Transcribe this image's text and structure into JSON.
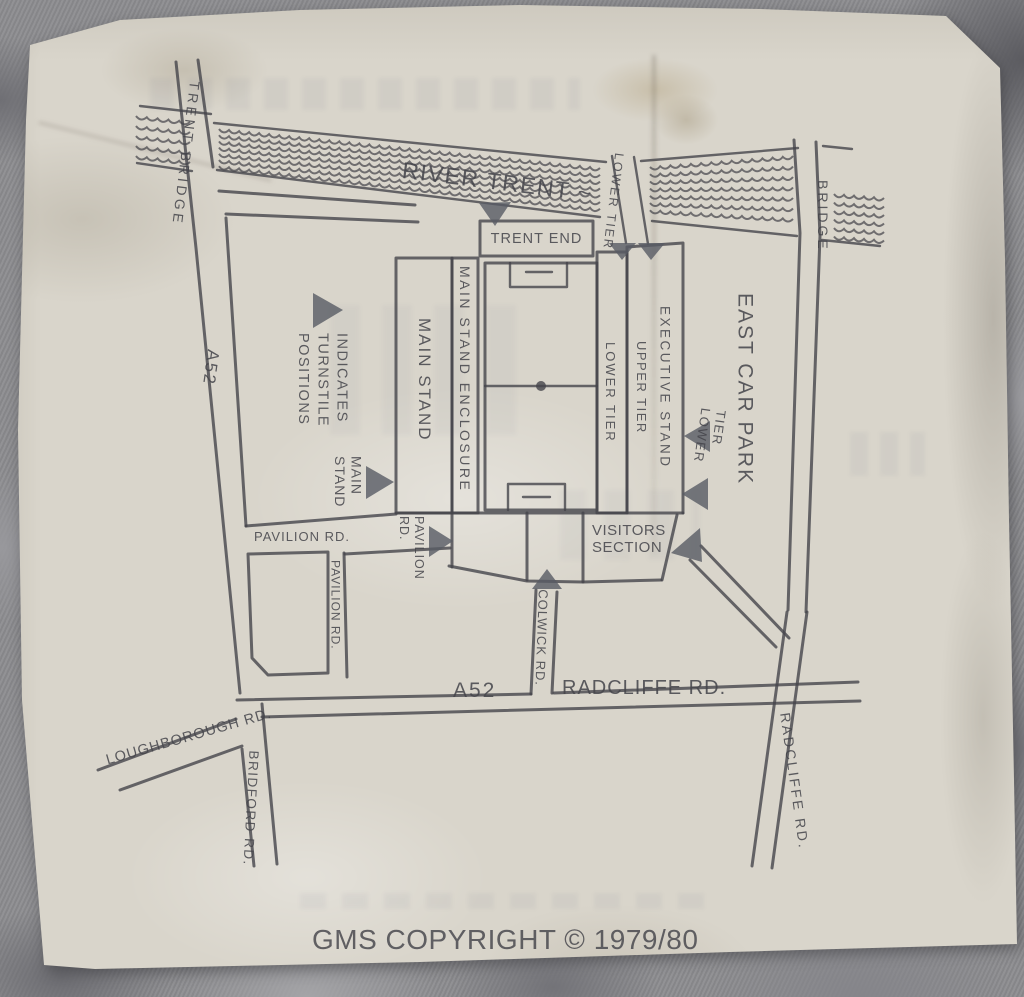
{
  "labels": {
    "river_trent": "RIVER TRENT ~",
    "trent_bridge_road": "TRENT BRIDGE",
    "bridge_road": "BRIDGE",
    "a52_west": "A52",
    "a52_south": "A52",
    "radcliffe_rd_south": "RADCLIFFE RD.",
    "radcliffe_rd_east": "RADCLIFFE RD.",
    "colwick_rd": "COLWICK RD.",
    "pavilion_rd_horizontal": "PAVILION RD.",
    "pavilion_rd_vertical": "PAVILION RD.",
    "pavilion_rd_stadium": "PAVILION\nRD.",
    "loughborough_rd": "LOUGHBOROUGH RD.",
    "bridford_rd": "BRIDFORD RD.",
    "trent_end": "TRENT END",
    "main_stand": "MAIN STAND",
    "main_stand_enclosure": "MAIN STAND ENCLOSURE",
    "lower_tier_stand": "LOWER TIER",
    "upper_tier": "UPPER TIER",
    "executive_stand": "EXECUTIVE STAND",
    "lower_tier_river": "LOWER TIER",
    "lower_tier_east": "LOWER\nTIER",
    "visitors_section": "VISITORS\nSECTION",
    "east_car_park": "EAST CAR PARK",
    "legend_note": "INDICATES\nTURNSTILE\nPOSITIONS",
    "main_stand_pointer": "MAIN\nSTAND",
    "copyright": "GMS COPYRIGHT © 1979/80"
  },
  "colors": {
    "ink": "#45454b",
    "paper": "#d9d5cb",
    "stone": "#8d8d90",
    "arrow": "#575b64"
  }
}
